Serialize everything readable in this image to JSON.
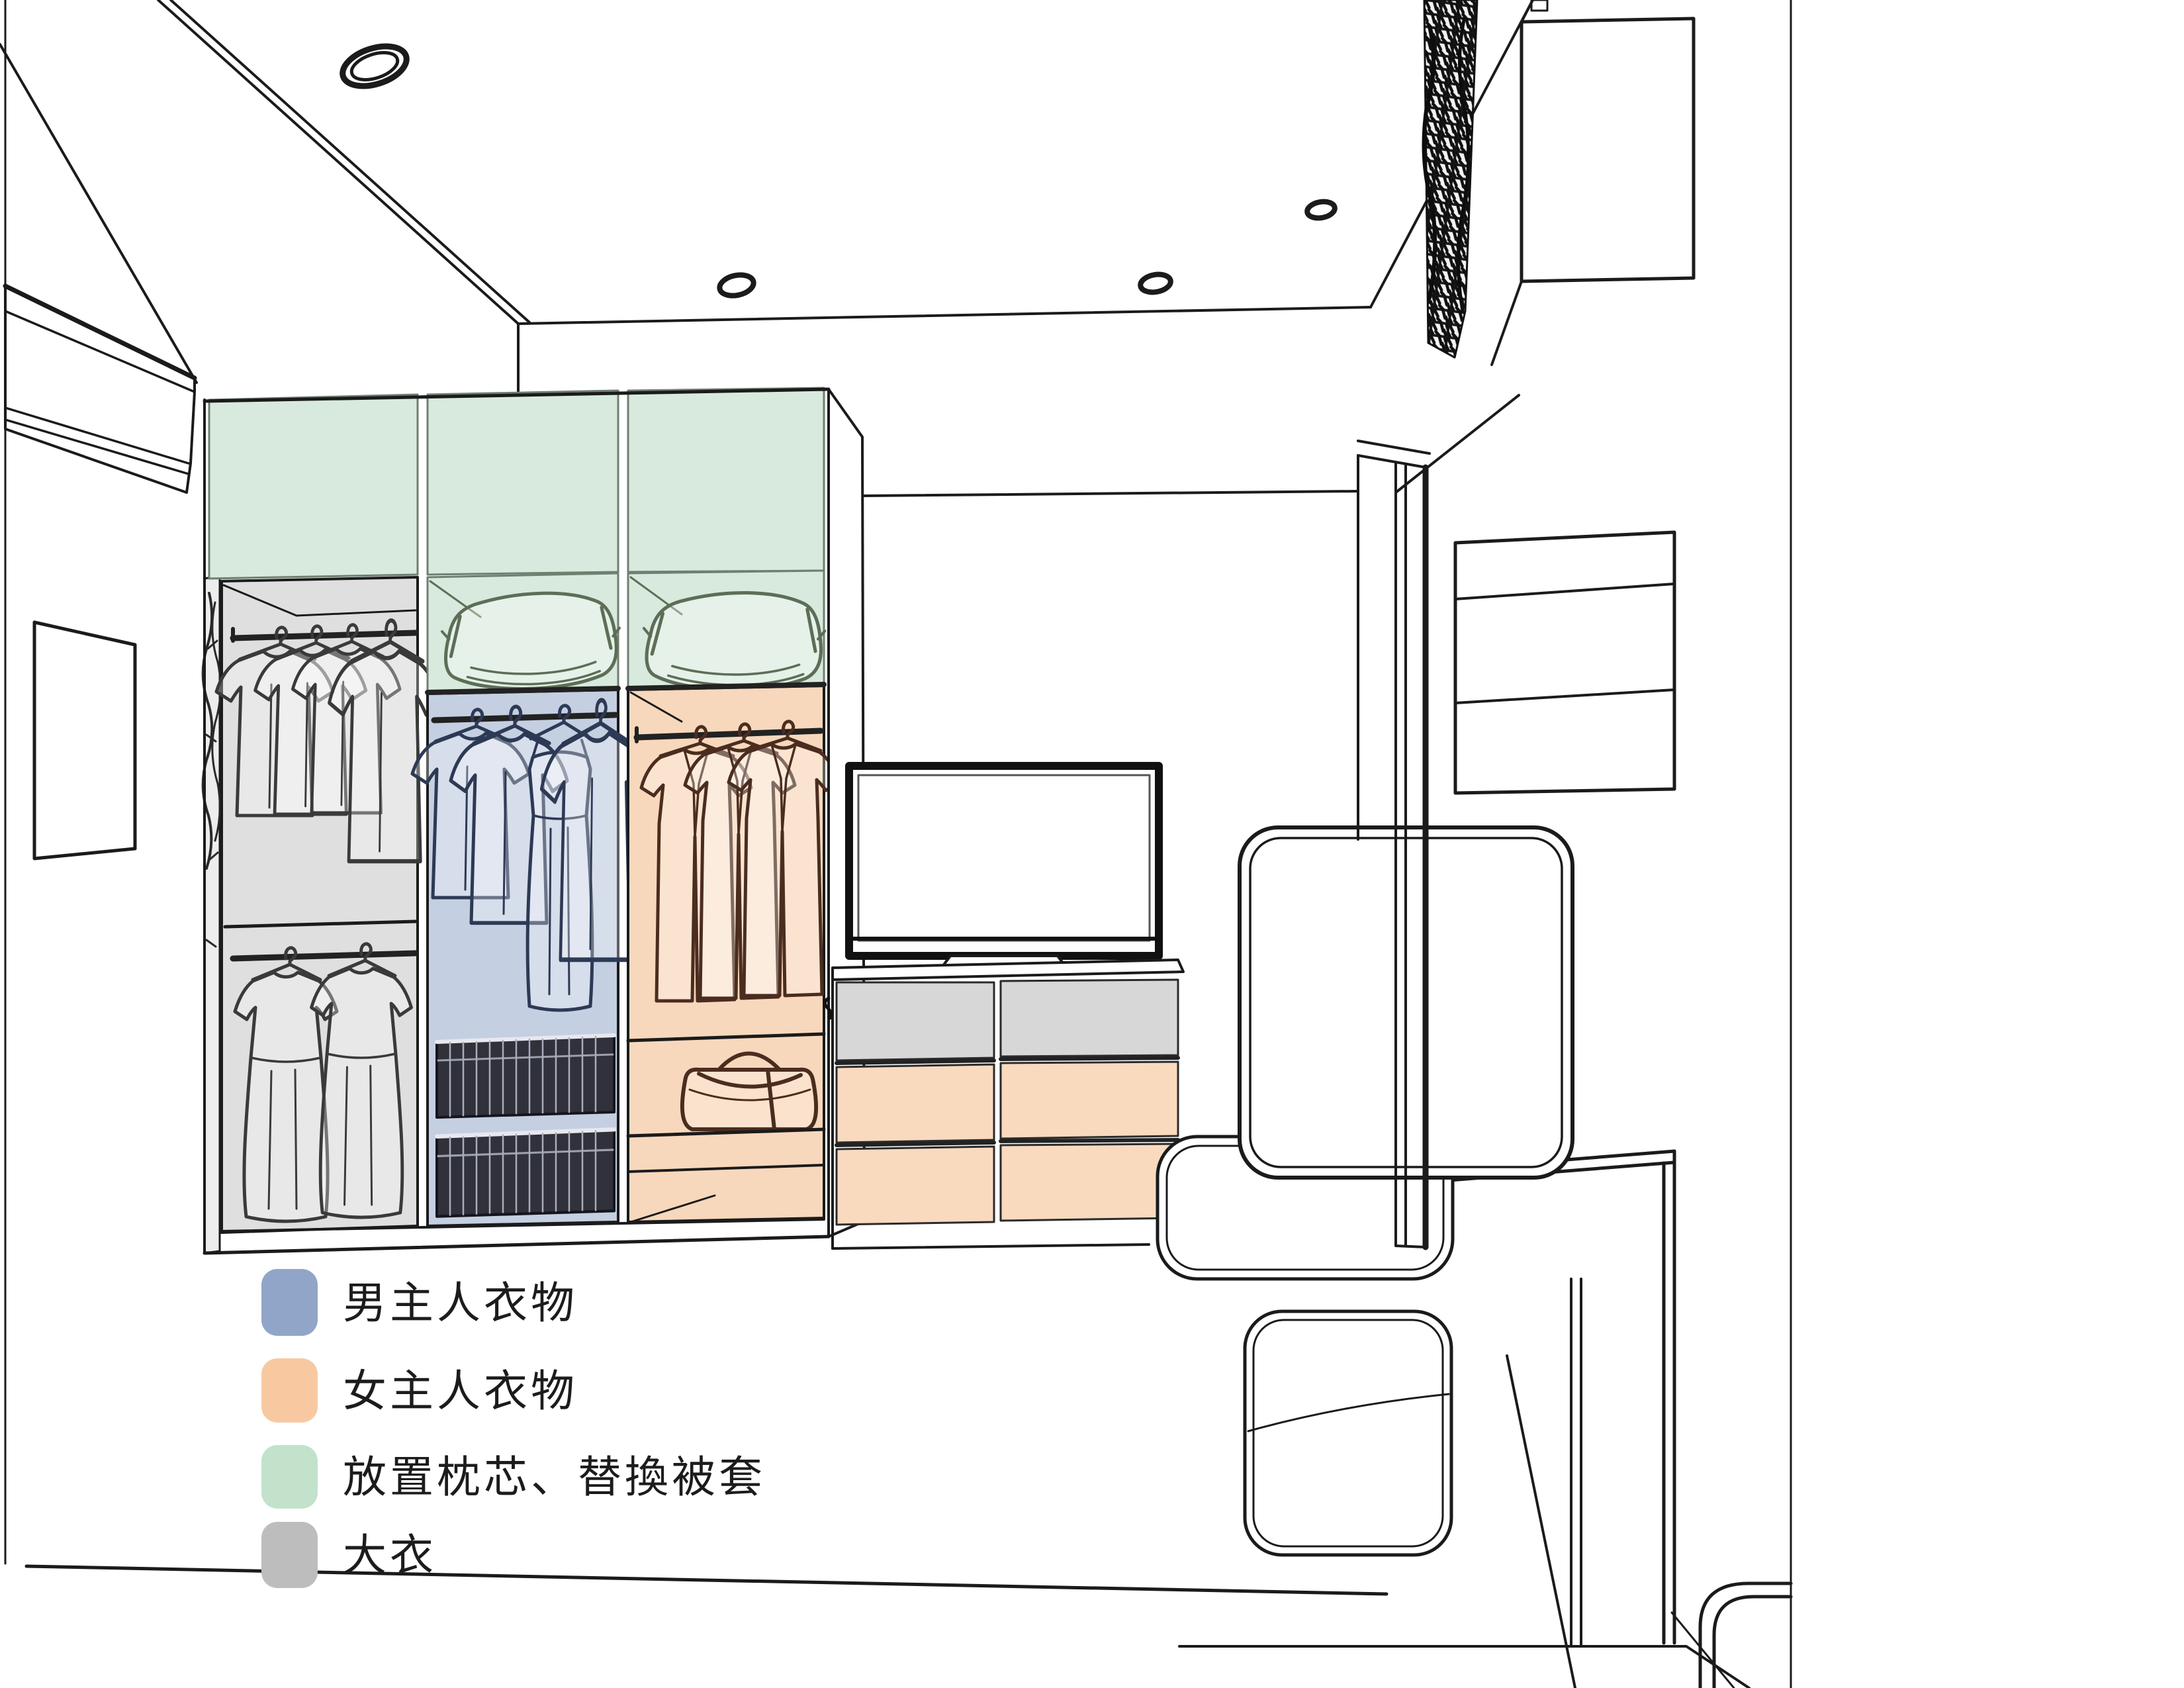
{
  "legend": {
    "items": [
      {
        "id": "male-clothes",
        "label": "男主人衣物",
        "color": "#90A5C8"
      },
      {
        "id": "female-clothes",
        "label": "女主人衣物",
        "color": "#F8C9A1"
      },
      {
        "id": "bedding",
        "label": "放置枕芯、替換被套",
        "color": "#C2E2CB"
      },
      {
        "id": "coats",
        "label": "大衣",
        "color": "#BDBDBD"
      }
    ]
  },
  "palette": {
    "line": "#1b1b1b",
    "section_green": "#D8EADD",
    "section_green_stroke": "#6f7f70",
    "section_blue": "#C5CFE2",
    "section_orange": "#F8D8BC",
    "section_gray": "#DFDFDF",
    "drawer_gray": "#D7D7D7",
    "drawer_orange": "#F9DABF",
    "pillow_stroke": "#5d6e57",
    "clothes_gray": "#3a3a3a",
    "clothes_blue": "#2d3a55",
    "clothes_orange": "#4b2d1f",
    "basket_dark": "#31313b",
    "artwork_dark": "#101010"
  }
}
